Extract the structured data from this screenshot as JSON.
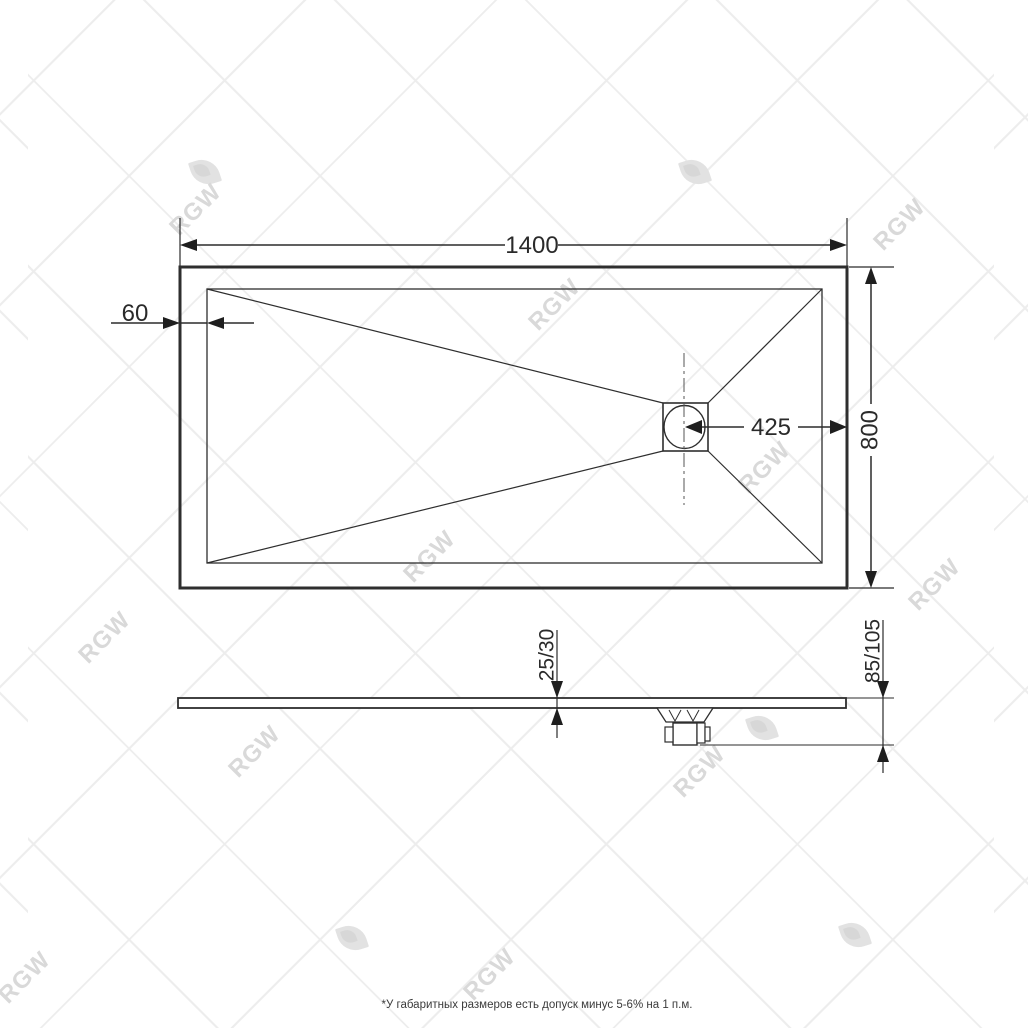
{
  "watermark": {
    "brand": "RGW"
  },
  "top_view": {
    "width_label": "1400",
    "depth_label": "800",
    "edge_label": "60",
    "drain_offset_label": "425"
  },
  "section_view": {
    "thickness_label": "25/30",
    "height_label": "85/105"
  },
  "footnote": "*У габаритных размеров есть допуск минус  5-6% на 1 п.м."
}
